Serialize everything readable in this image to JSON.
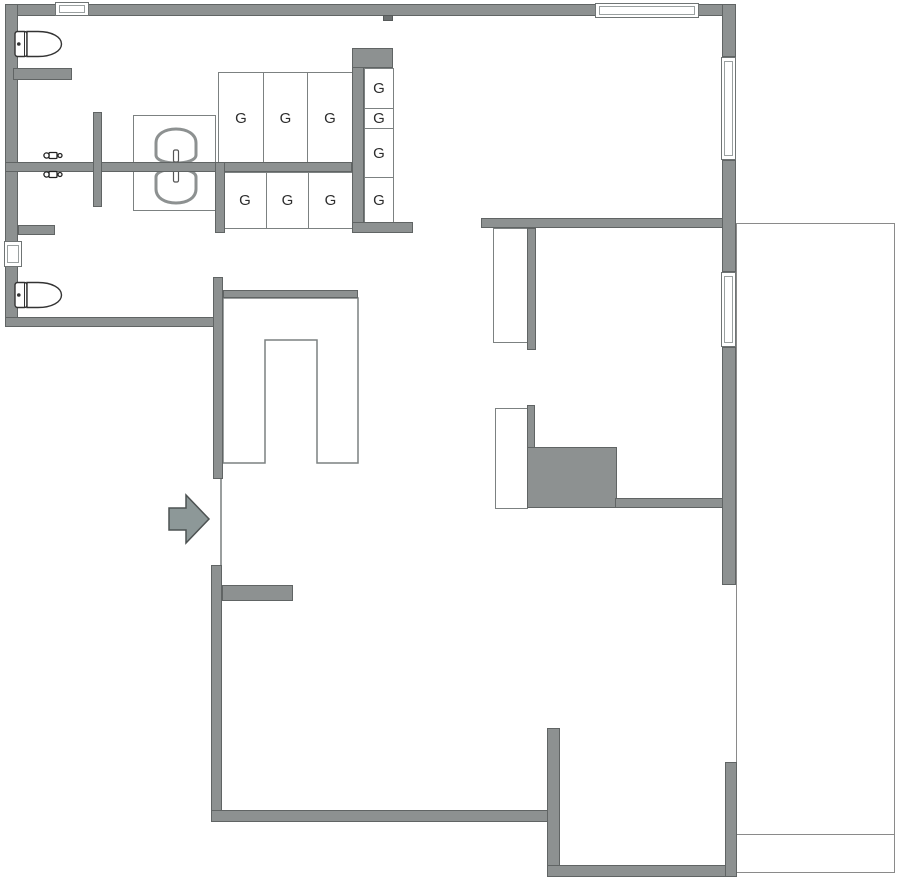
{
  "plan_title": "Floor plan",
  "lockers": {
    "top_row": [
      "G",
      "G",
      "G"
    ],
    "bottom_row": [
      "G",
      "G",
      "G"
    ],
    "side_column": [
      "G",
      "G",
      "G",
      "G"
    ]
  },
  "colors": {
    "wall_fill": "#8d9191",
    "wall_edge": "#606464",
    "thin_outline": "#7c8181",
    "fixture_stroke": "#2f2f2f",
    "arrow_fill": "#8d9898",
    "background": "#ffffff"
  }
}
